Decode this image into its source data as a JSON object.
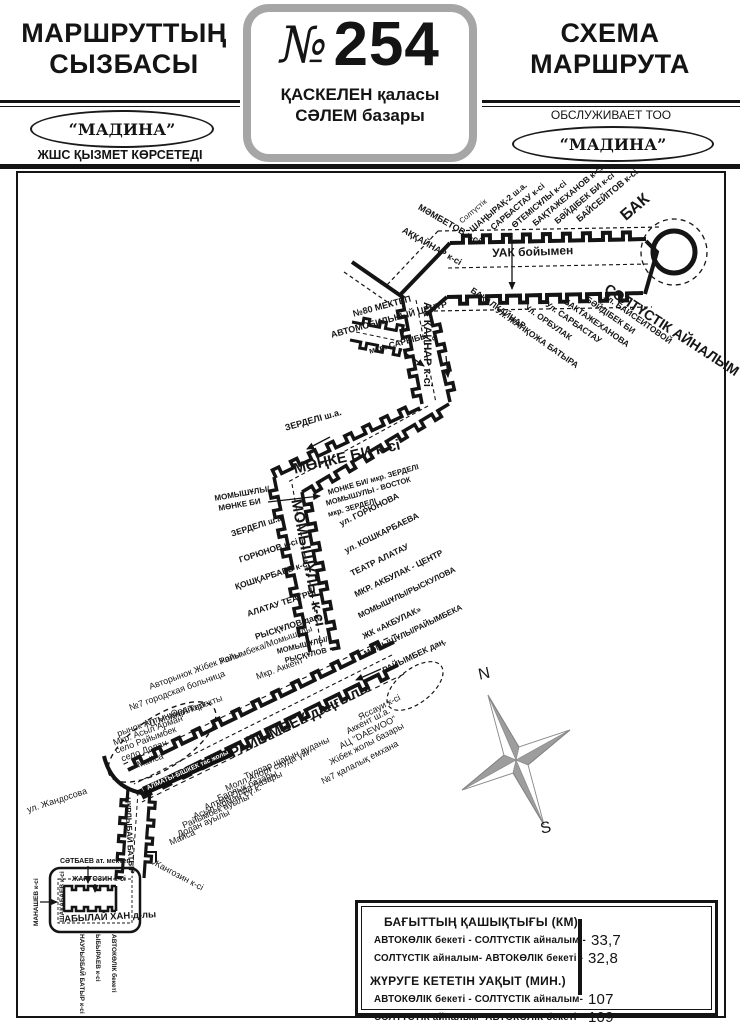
{
  "header": {
    "title_left": "МАРШРУТТЫҢ СЫЗБАСЫ",
    "title_left_line1": "МАРШРУТТЫҢ",
    "title_left_line2": "СЫЗБАСЫ",
    "route_no_symbol": "№",
    "route_number": "254",
    "route_city": "ҚАСКЕЛЕН қаласы",
    "route_terminus": "СӘЛЕМ базары",
    "title_right_line1": "СХЕМА",
    "title_right_line2": "МАРШРУТА",
    "operator_left_name": "“МАДИНА”",
    "operator_left_sub": "ЖШС ҚЫЗМЕТ КӨРСЕТЕДІ",
    "operator_right_pre": "ОБСЛУЖИВАЕТ ТОО",
    "operator_right_name": "“МАДИНА”"
  },
  "colors": {
    "ink": "#141414",
    "gray_border": "#a6a6a6",
    "compass_gray": "#9d9d9d"
  },
  "compass": {
    "north": "N",
    "south": "S"
  },
  "map": {
    "labels": [
      {
        "t": "МӘМБЕТОВ к-сі",
        "x": 421,
        "y": 203,
        "r": 30,
        "s": 9,
        "b": 1
      },
      {
        "t": "АҚҚАЙНАР к-сі",
        "x": 405,
        "y": 226,
        "r": 30,
        "s": 9,
        "b": 1
      },
      {
        "t": "Солтүстік",
        "x": 458,
        "y": 219,
        "r": -40,
        "s": 7.5
      },
      {
        "t": "ШАҢЫРАҚ-2 ш.а.",
        "x": 468,
        "y": 227,
        "r": -40,
        "s": 8.5,
        "b": 1
      },
      {
        "t": "САРБАСТАУ к-сі",
        "x": 489,
        "y": 225,
        "r": -40,
        "s": 8.5,
        "b": 1
      },
      {
        "t": "ӨТЕМІСҰЛЫ к-сі",
        "x": 510,
        "y": 223,
        "r": -40,
        "s": 8.5,
        "b": 1
      },
      {
        "t": "БАҚТАЖЕХАНОВ к-сі",
        "x": 531,
        "y": 221,
        "r": -40,
        "s": 8.5,
        "b": 1
      },
      {
        "t": "БӘЙДІБЕК БИ к-сі",
        "x": 553,
        "y": 219,
        "r": -40,
        "s": 8.5,
        "b": 1
      },
      {
        "t": "БАЙСЕЙІТОВ к-сі",
        "x": 575,
        "y": 217,
        "r": -40,
        "s": 9,
        "b": 1
      },
      {
        "t": "БАК",
        "x": 618,
        "y": 212,
        "r": -40,
        "s": 16,
        "b": 1
      },
      {
        "t": "УАК бойымен",
        "x": 492,
        "y": 247,
        "r": -2,
        "s": 12,
        "b": 1
      },
      {
        "t": "БАКАЛКАЙНАР",
        "x": 474,
        "y": 286,
        "r": 35,
        "s": 8.5,
        "b": 1
      },
      {
        "t": "Ул. ЖАНҚОЖА БАТЫРА",
        "x": 499,
        "y": 306,
        "r": 35,
        "s": 8.5,
        "b": 1
      },
      {
        "t": "Ул. ОРБУЛАК",
        "x": 528,
        "y": 303,
        "r": 35,
        "s": 8.5,
        "b": 1
      },
      {
        "t": "Ул. САРБАСТАУ",
        "x": 549,
        "y": 300,
        "r": 35,
        "s": 8.5,
        "b": 1
      },
      {
        "t": "БАКТАЖЕХАНОВА",
        "x": 567,
        "y": 297,
        "r": 35,
        "s": 8.5,
        "b": 1
      },
      {
        "t": "БӘЙДІБЕК БИ",
        "x": 589,
        "y": 295,
        "r": 35,
        "s": 8.5,
        "b": 1
      },
      {
        "t": "Ул. БАЙСЕИТОВОЙ",
        "x": 607,
        "y": 292,
        "r": 35,
        "s": 8.5,
        "b": 1
      },
      {
        "t": "СОЛТҮСТІК АЙНАЛЫМ",
        "x": 610,
        "y": 281,
        "r": 33,
        "s": 14,
        "b": 1
      },
      {
        "t": "№80 МЕКТЕП",
        "x": 352,
        "y": 310,
        "r": -15,
        "s": 9,
        "b": 1
      },
      {
        "t": "АВТОМОБИЛЬНЫЙ ЦЕНТР",
        "x": 330,
        "y": 331,
        "r": -15,
        "s": 9,
        "b": 1
      },
      {
        "t": "мкр. САРЫБЫ",
        "x": 368,
        "y": 347,
        "r": -15,
        "s": 8.5,
        "b": 1
      },
      {
        "t": "АК ҚАЙНАР к-сі",
        "x": 432,
        "y": 302,
        "r": 90,
        "s": 11,
        "b": 1
      },
      {
        "t": "ЗЕРДЕЛІ ш.а.",
        "x": 284,
        "y": 424,
        "r": -16,
        "s": 9,
        "b": 1
      },
      {
        "t": "МӨҢКЕ БИ к-сі",
        "x": 292,
        "y": 462,
        "r": -13,
        "s": 15,
        "b": 1
      },
      {
        "t": "МОНКЕ БИ/ мкр. ЗЕРДЕЛІ",
        "x": 327,
        "y": 489,
        "r": -16,
        "s": 7.5,
        "b": 1
      },
      {
        "t": "МОМЫШУЛЫ - ВОСТОК",
        "x": 325,
        "y": 500,
        "r": -16,
        "s": 7.5,
        "b": 1
      },
      {
        "t": "мкр. ЗЕРДЕЛІ",
        "x": 327,
        "y": 511,
        "r": -16,
        "s": 7.5,
        "b": 1
      },
      {
        "t": "МОМЫШҰЛЫ к-сі",
        "x": 303,
        "y": 498,
        "r": 79,
        "s": 15,
        "b": 1
      },
      {
        "t": "МОМЫШҰЛЫ/",
        "x": 214,
        "y": 495,
        "r": -10,
        "s": 8,
        "b": 1
      },
      {
        "t": "МӨНКЕ БИ",
        "x": 218,
        "y": 505,
        "r": -10,
        "s": 8,
        "b": 1
      },
      {
        "t": "ЗЕРДЕЛІ ш.а.",
        "x": 230,
        "y": 530,
        "r": -18,
        "s": 8.5,
        "b": 1
      },
      {
        "t": "ГОРЮНОВ к-сі",
        "x": 238,
        "y": 556,
        "r": -18,
        "s": 8.5,
        "b": 1
      },
      {
        "t": "ҚОШҚАРБАЕВ к-сі",
        "x": 234,
        "y": 583,
        "r": -18,
        "s": 8.5,
        "b": 1
      },
      {
        "t": "АЛАТАУ ТЕАТРЫ",
        "x": 246,
        "y": 610,
        "r": -18,
        "s": 8.5,
        "b": 1
      },
      {
        "t": "РЫСҚҰЛОВ даң.",
        "x": 254,
        "y": 633,
        "r": -18,
        "s": 8.5,
        "b": 1
      },
      {
        "t": "МОМЫШҰЛЫ/",
        "x": 276,
        "y": 648,
        "r": -14,
        "s": 7.5,
        "b": 1
      },
      {
        "t": "РЫСҚҰЛОВ",
        "x": 284,
        "y": 657,
        "r": -14,
        "s": 7.5,
        "b": 1
      },
      {
        "t": "ул. ГОРЮНОВА",
        "x": 338,
        "y": 520,
        "r": -26,
        "s": 8.5,
        "b": 1
      },
      {
        "t": "ул. КОШКАРБАЕВА",
        "x": 343,
        "y": 547,
        "r": -26,
        "s": 8.5,
        "b": 1
      },
      {
        "t": "ТЕАТР АЛАТАУ",
        "x": 349,
        "y": 570,
        "r": -26,
        "s": 8.5,
        "b": 1
      },
      {
        "t": "МКР. АКБУЛАК - ЦЕНТР",
        "x": 353,
        "y": 591,
        "r": -26,
        "s": 8.5,
        "b": 1
      },
      {
        "t": "МОМЫШҰЛЫ/РЫСКУЛОВА",
        "x": 357,
        "y": 613,
        "r": -26,
        "s": 8,
        "b": 1
      },
      {
        "t": "ЖК «АКБУЛАК»",
        "x": 361,
        "y": 633,
        "r": -26,
        "s": 8.5,
        "b": 1
      },
      {
        "t": "МОМЫШҰЛЫ/РАЙЫМБЕКА",
        "x": 363,
        "y": 651,
        "r": -26,
        "s": 8,
        "b": 1
      },
      {
        "t": "РАЙЫМБЕК даң.",
        "x": 381,
        "y": 667,
        "r": -26,
        "s": 8.5,
        "b": 1
      },
      {
        "t": "Райымбека/Момышулы",
        "x": 218,
        "y": 658,
        "r": -20,
        "s": 9
      },
      {
        "t": "Мкр. Аккент",
        "x": 255,
        "y": 673,
        "r": -20,
        "s": 9
      },
      {
        "t": "Авторынок Жібек жолы",
        "x": 148,
        "y": 683,
        "r": -20,
        "s": 9
      },
      {
        "t": "№7 городская больница",
        "x": 128,
        "y": 704,
        "r": -20,
        "s": 9
      },
      {
        "t": "Мкр. Теректы",
        "x": 168,
        "y": 713,
        "r": -20,
        "s": 9
      },
      {
        "t": "ТЦ Молл Апорт",
        "x": 143,
        "y": 722,
        "r": -20,
        "s": 9
      },
      {
        "t": "рынок Алтын Орда",
        "x": 116,
        "y": 730,
        "r": -20,
        "s": 9
      },
      {
        "t": "Мкр. Асыл Арман",
        "x": 112,
        "y": 739,
        "r": -20,
        "s": 9
      },
      {
        "t": "село Райымбек",
        "x": 114,
        "y": 747,
        "r": -20,
        "s": 9
      },
      {
        "t": "село Долан",
        "x": 120,
        "y": 755,
        "r": -20,
        "s": 9
      },
      {
        "t": "Майса",
        "x": 136,
        "y": 761,
        "r": -20,
        "s": 9
      },
      {
        "t": "РАЙЫМБЕК даңғылы",
        "x": 228,
        "y": 748,
        "r": -26,
        "s": 14.5,
        "b": 1
      },
      {
        "t": "АЛМАТЫ-БІШКЕК тас жолы",
        "x": 142,
        "y": 787,
        "r": -24,
        "s": 6.5,
        "b": 1,
        "inv": 1
      },
      {
        "t": "Тулпар шағын ауданы",
        "x": 243,
        "y": 773,
        "r": -24,
        "s": 9
      },
      {
        "t": "Молл Апорт сауда үйі",
        "x": 224,
        "y": 785,
        "r": -24,
        "s": 9
      },
      {
        "t": "Барлык базары",
        "x": 216,
        "y": 795,
        "r": -24,
        "s": 9
      },
      {
        "t": "Алтын Орда базары",
        "x": 203,
        "y": 804,
        "r": -24,
        "s": 9
      },
      {
        "t": "Асыл Арман т.ү.к.",
        "x": 192,
        "y": 813,
        "r": -24,
        "s": 9
      },
      {
        "t": "Райымбек ауылы",
        "x": 181,
        "y": 822,
        "r": -24,
        "s": 9
      },
      {
        "t": "Долан ауылы",
        "x": 176,
        "y": 831,
        "r": -24,
        "s": 9
      },
      {
        "t": "Майса",
        "x": 168,
        "y": 839,
        "r": -24,
        "s": 9
      },
      {
        "t": "Яссауи к-сі",
        "x": 357,
        "y": 714,
        "r": -27,
        "s": 9
      },
      {
        "t": "Аккент ш.а.",
        "x": 345,
        "y": 728,
        "r": -27,
        "s": 9
      },
      {
        "t": "АЦ \"DAEWOO\"",
        "x": 338,
        "y": 743,
        "r": -27,
        "s": 9
      },
      {
        "t": "Жібек жолы базары",
        "x": 328,
        "y": 759,
        "r": -27,
        "s": 9
      },
      {
        "t": "№7 қалалық емхана",
        "x": 320,
        "y": 778,
        "r": -27,
        "s": 9
      },
      {
        "t": "ул. Жандосова",
        "x": 26,
        "y": 806,
        "r": -18,
        "s": 9
      },
      {
        "t": "Жангозин к-сі",
        "x": 155,
        "y": 858,
        "r": 28,
        "s": 9
      },
      {
        "t": "НҰРЛЫБАЙ БАТЫР",
        "x": 131,
        "y": 797,
        "r": 87,
        "s": 8,
        "b": 1
      },
      {
        "t": "СӘТБАЕВ ат. мектеп",
        "x": 60,
        "y": 858,
        "r": 0,
        "s": 7,
        "b": 1
      },
      {
        "t": "ЖАНГОЗИН к-сі",
        "x": 72,
        "y": 876,
        "r": 0,
        "s": 7,
        "b": 1
      },
      {
        "t": "МАНАШЕВ к-сі",
        "x": 34,
        "y": 926,
        "r": -90,
        "s": 6.5,
        "b": 1
      },
      {
        "t": "ШАКАБАЕВ к-сі",
        "x": 60,
        "y": 922,
        "r": -90,
        "s": 6.5,
        "b": 1
      },
      {
        "t": "АБЫЛАЙ ХАН д-лы",
        "x": 64,
        "y": 915,
        "r": -3,
        "s": 9.5,
        "b": 1
      },
      {
        "t": "НАУРЫЗБАЙ БАТЫР к-сі",
        "x": 84,
        "y": 934,
        "r": 90,
        "s": 6.5,
        "b": 1
      },
      {
        "t": "ЫБЫРАЕВ к-сі",
        "x": 100,
        "y": 934,
        "r": 90,
        "s": 6.5,
        "b": 1
      },
      {
        "t": "АВТОКӨЛІК бекеті",
        "x": 116,
        "y": 934,
        "r": 90,
        "s": 6.5,
        "b": 1
      },
      {
        "t": "N",
        "x": 477,
        "y": 668,
        "r": -12,
        "s": 16,
        "n": "compass-north-label"
      },
      {
        "t": "S",
        "x": 539,
        "y": 822,
        "r": -12,
        "s": 16,
        "n": "compass-south-label"
      }
    ]
  },
  "info_box": {
    "title_distance": "БАҒЫТТЫҢ ҚАШЫҚТЫҒЫ   (КМ)",
    "distance_lines": [
      {
        "label": "АВТОКӨЛІК бекеті - СОЛТҮСТІК айналым -",
        "value": "33,7"
      },
      {
        "label": "СОЛТҮСТІК айналым- АВТОКӨЛІК бекеті  -",
        "value": "32,8"
      }
    ],
    "title_time": "ЖҮРУГЕ КЕТЕТІН УАҚЫТ (МИН.)",
    "time_lines": [
      {
        "label": "АВТОКӨЛІК бекеті - СОЛТҮСТІК айналым-",
        "value": "107"
      },
      {
        "label": "СОЛТҮСТІК айналым- АВТОКӨЛІК бекеті  -",
        "value": "109"
      }
    ]
  }
}
